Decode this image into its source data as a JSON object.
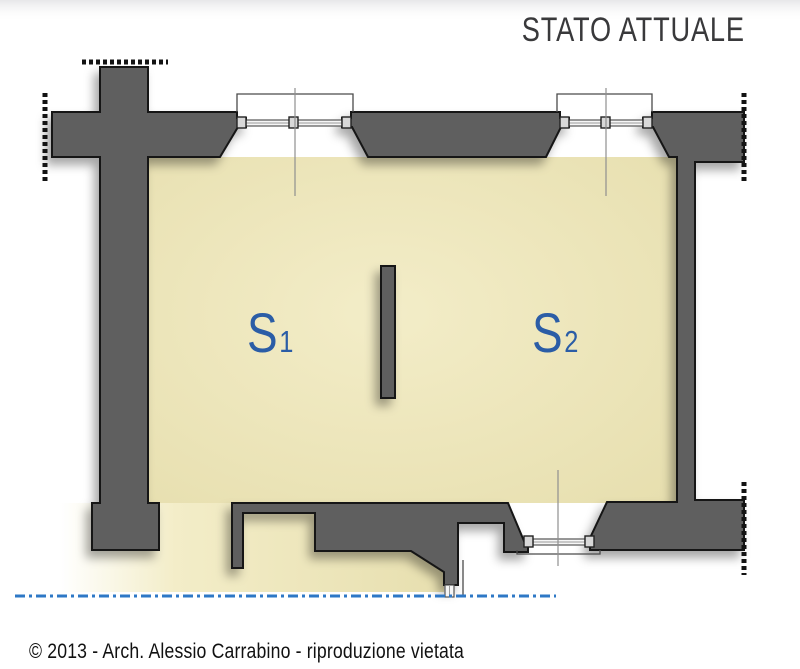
{
  "header": {
    "title": "STATO ATTUALE"
  },
  "rooms": [
    {
      "name": "S",
      "index": "1"
    },
    {
      "name": "S",
      "index": "2"
    }
  ],
  "footer": {
    "copyright": "© 2013 - Arch. Alessio Carrabino - riproduzione vietata"
  },
  "plan": {
    "type": "architectural-floor-plan",
    "elements": [
      "left-cross-wall",
      "top-wall",
      "window-1",
      "window-2",
      "right-wall",
      "bottom-wall",
      "door-opening",
      "porch-wall",
      "partition-wall",
      "ground-section-line",
      "wall-cut-marks"
    ]
  },
  "colors": {
    "wall": "#5f5f5f",
    "outline": "#131313",
    "floor": "#f3edc8",
    "floor_deep": "#e7dfaf",
    "frame_fill": "#f6f6f6",
    "label": "#2b5da6",
    "section_line": "#2e78c6",
    "title_text": "#39393b",
    "body_text": "#111111"
  }
}
